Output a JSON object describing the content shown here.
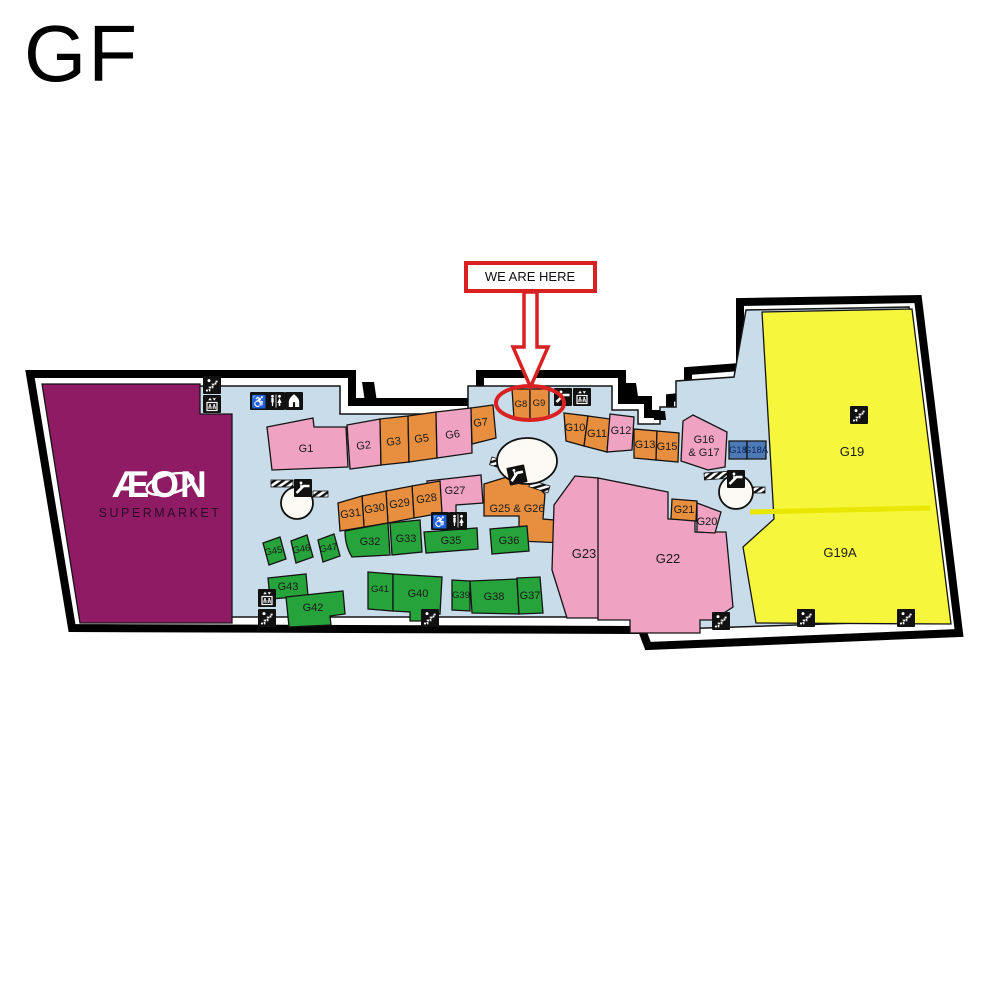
{
  "page": {
    "floor_label": "GF"
  },
  "marker": {
    "label": "WE ARE HERE"
  },
  "anchor": {
    "name": "ÆON",
    "subtitle": "SUPERMARKET"
  },
  "units": {
    "g1": "G1",
    "g2": "G2",
    "g3": "G3",
    "g5": "G5",
    "g6": "G6",
    "g7": "G7",
    "g8": "G8",
    "g9": "G9",
    "g10": "G10",
    "g11": "G11",
    "g12": "G12",
    "g13": "G13",
    "g15": "G15",
    "g16_17_top": "G16",
    "g16_17_bottom": "& G17",
    "g18": "G18",
    "g18a": "G18A",
    "g19": "G19",
    "g19a": "G19A",
    "g20": "G20",
    "g21": "G21",
    "g22": "G22",
    "g23": "G23",
    "g25_26": "G25 & G26",
    "g27": "G27",
    "g28": "G28",
    "g29": "G29",
    "g30": "G30",
    "g31": "G31",
    "g32": "G32",
    "g33": "G33",
    "g35": "G35",
    "g36": "G36",
    "g37": "G37",
    "g38": "G38",
    "g39": "G39",
    "g40": "G40",
    "g41": "G41",
    "g42": "G42",
    "g43": "G43",
    "g45": "G45",
    "g46": "G46",
    "g47": "G47"
  },
  "colors": {
    "anchor": "#8e1b63",
    "pink": "#efa2c2",
    "orange": "#e78f3f",
    "green": "#27a33c",
    "yellow": "#f6f63c",
    "blue_unit": "#4d79b4",
    "floor": "#c9dcea",
    "marker_red": "#d92121",
    "wall": "#000000"
  },
  "icons": {
    "wheelchair_glyph": "♿"
  }
}
